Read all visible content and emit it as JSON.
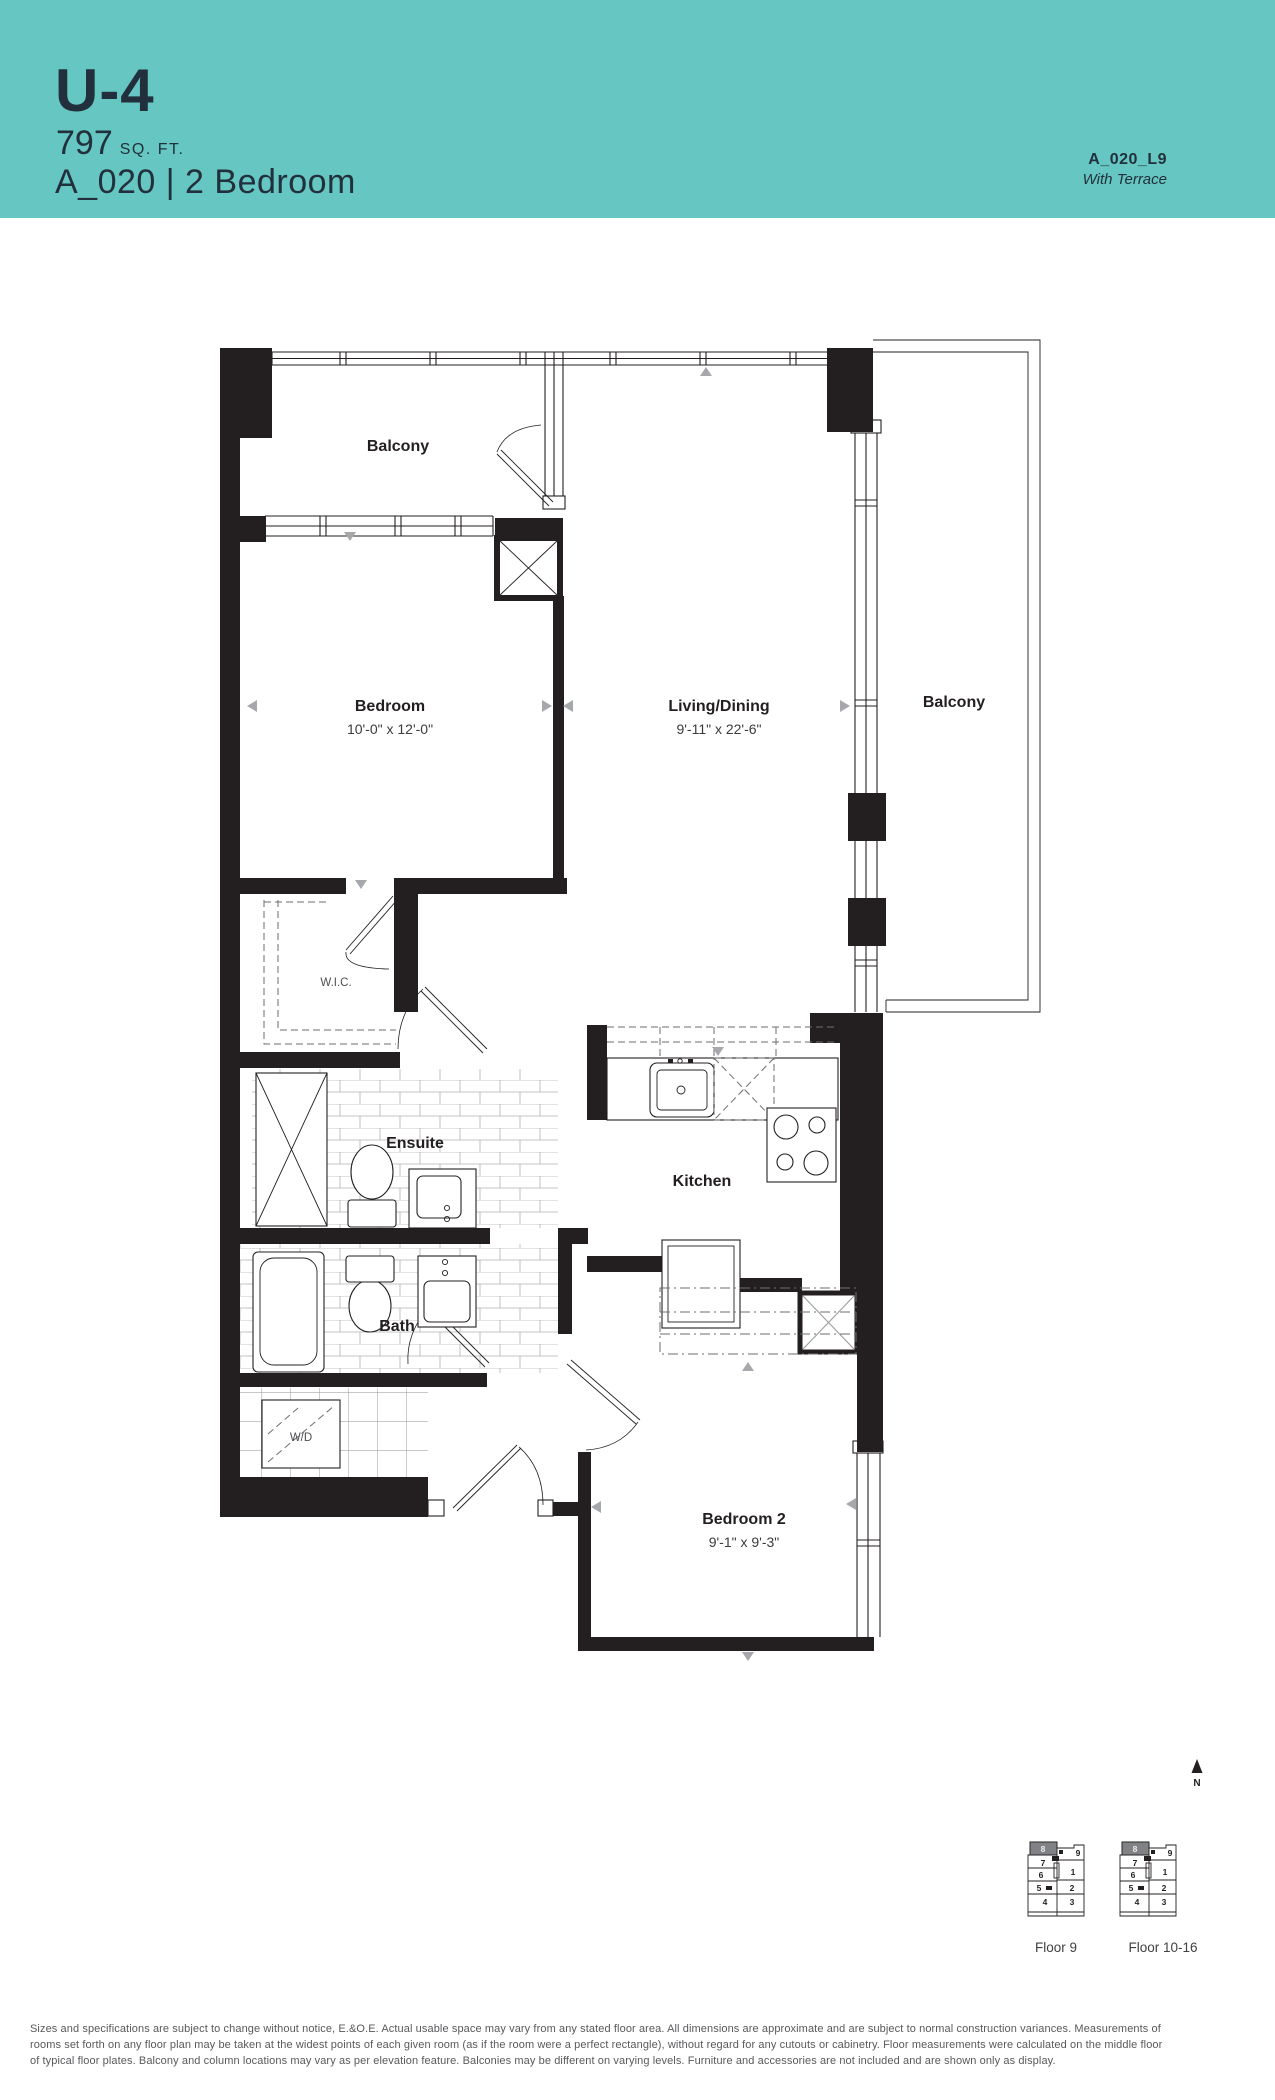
{
  "header": {
    "unit_code": "U-4",
    "area": "797",
    "area_unit": "SQ. FT.",
    "plan_title": "A_020 | 2 Bedroom",
    "plan_ref": "A_020_L9",
    "plan_ref_note": "With Terrace",
    "colors": {
      "band": "#66C6C1",
      "text": "#21303C",
      "wall": "#231F20",
      "marker_gray": "#A6A8AB"
    }
  },
  "plan": {
    "rooms": {
      "balcony_top": {
        "label": "Balcony"
      },
      "bedroom": {
        "label": "Bedroom",
        "dims": "10'-0\" x 12'-0\""
      },
      "living_dining": {
        "label": "Living/Dining",
        "dims": "9'-11\" x 22'-6\""
      },
      "balcony_right": {
        "label": "Balcony"
      },
      "wic": {
        "label": "W.I.C."
      },
      "ensuite": {
        "label": "Ensuite"
      },
      "kitchen": {
        "label": "Kitchen"
      },
      "bath": {
        "label": "Bath"
      },
      "wd": {
        "label": "W/D"
      },
      "bedroom2": {
        "label": "Bedroom 2",
        "dims": "9'-1\" x 9'-3\""
      }
    },
    "north_label": "N"
  },
  "keyplans": [
    {
      "label": "Floor 9",
      "highlighted_unit": "8",
      "units": [
        "9",
        "7",
        "6",
        "1",
        "5",
        "2",
        "4",
        "3"
      ]
    },
    {
      "label": "Floor 10-16",
      "highlighted_unit": "8",
      "units": [
        "9",
        "7",
        "6",
        "1",
        "5",
        "2",
        "4",
        "3"
      ]
    }
  ],
  "footer": {
    "lines": [
      "Sizes and specifications are subject to change without notice, E.&O.E. Actual usable space may vary from any stated floor area. All dimensions are approximate and are subject to normal construction variances. Measurements of",
      "rooms set forth on any floor plan may be taken at the widest points of each given room (as if the room were a perfect rectangle), without regard for any cutouts or cabinetry. Floor measurements were calculated on the middle floor",
      "of typical floor plates. Balcony and column locations may vary as per elevation feature. Balconies may be different on varying levels. Furniture and accessories are not included and are shown only as display."
    ]
  }
}
